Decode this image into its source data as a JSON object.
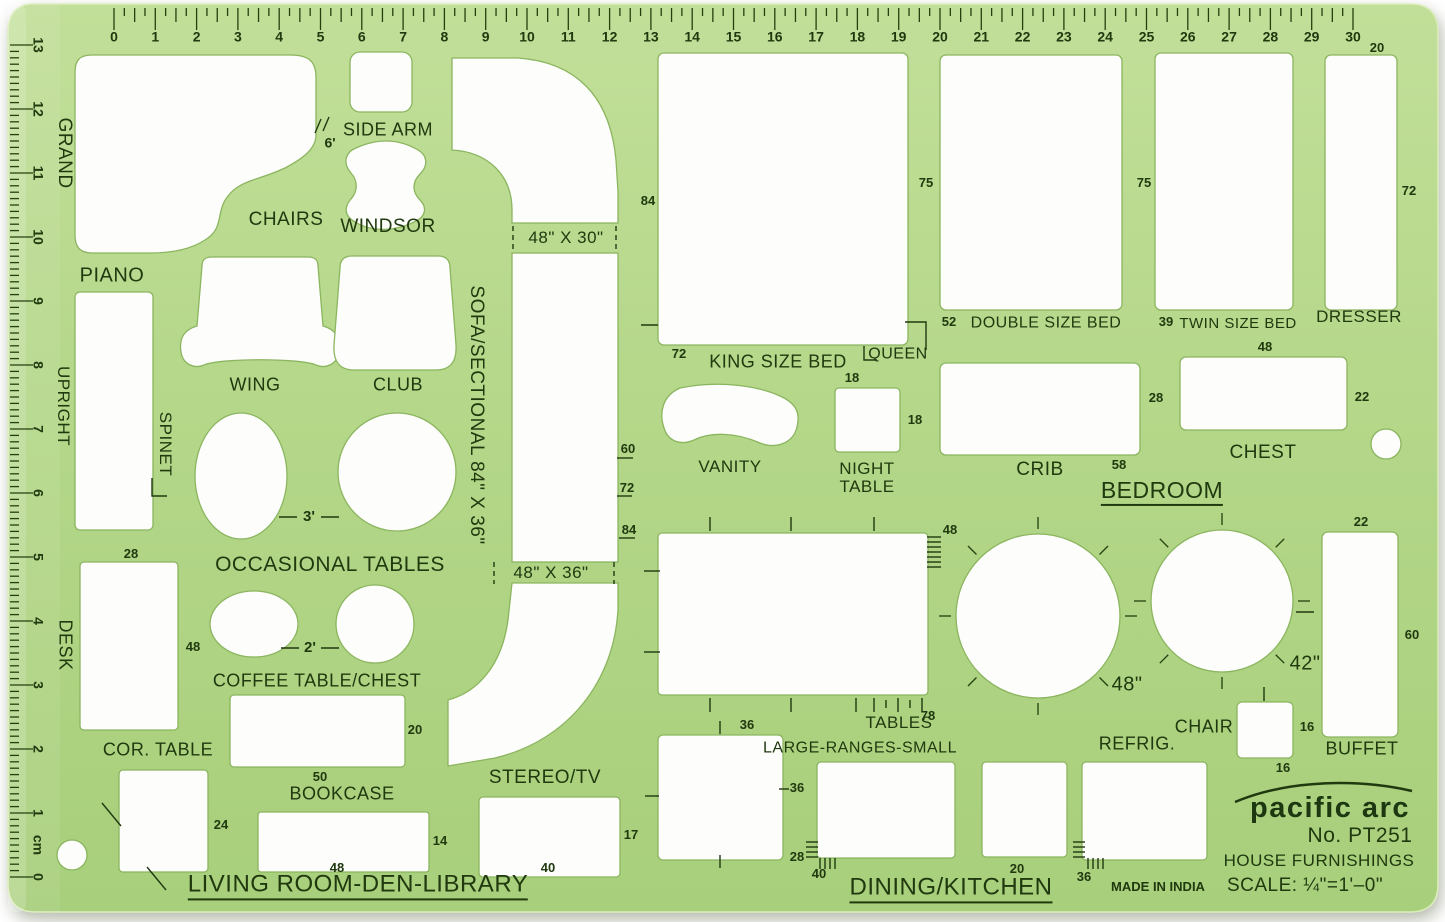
{
  "brand": {
    "logo": "pacific arc",
    "model": "No. PT251",
    "product": "HOUSE FURNISHINGS",
    "scale": "SCALE: ¼\"=1'–0\"",
    "origin": "MADE IN INDIA"
  },
  "sections": {
    "bedroom": "BEDROOM",
    "living": "LIVING ROOM-DEN-LIBRARY",
    "dining": "DINING/KITCHEN"
  },
  "labels": {
    "grand": "GRAND",
    "piano": "PIANO",
    "upright": "UPRIGHT",
    "spinet": "SPINET",
    "chairs": "CHAIRS",
    "windsor": "WINDSOR",
    "side_arm": "SIDE ARM",
    "wing": "WING",
    "club": "CLUB",
    "occasional": "OCCASIONAL TABLES",
    "desk": "DESK",
    "coffee": "COFFEE TABLE/CHEST",
    "cor_table": "COR. TABLE",
    "bookcase": "BOOKCASE",
    "stereo": "STEREO/TV",
    "sofa": "SOFA/SECTIONAL 84\" X 36\"",
    "king": "KING SIZE BED",
    "queen": "QUEEN",
    "vanity": "VANITY",
    "night": "NIGHT TABLE",
    "double": "DOUBLE SIZE BED",
    "twin": "TWIN SIZE BED",
    "dresser": "DRESSER",
    "crib": "CRIB",
    "chest": "CHEST",
    "buffet": "BUFFET",
    "chair": "CHAIR",
    "refrig": "REFRIG.",
    "tables": "TABLES",
    "ranges": "LARGE-RANGES-SMALL"
  },
  "dims": {
    "six_ft": "6'",
    "three_ft": "3'",
    "two_ft": "2'",
    "bridge1": "48\" X 30\"",
    "bridge2": "48\" X 36\"",
    "desk_w": "28",
    "desk_l": "48",
    "coffee_20": "20",
    "cor_24": "24",
    "book_50": "50",
    "book_14": "14",
    "book_48": "48",
    "stereo_17": "17",
    "stereo_40": "40",
    "sofa_84": "84",
    "king_72": "72",
    "side_60": "60",
    "side_72": "72",
    "side_84": "84",
    "night_18a": "18",
    "night_18b": "18",
    "double_52": "52",
    "double_75": "75",
    "twin_39": "39",
    "twin_75": "75",
    "dresser_20": "20",
    "dresser_72": "72",
    "crib_28": "28",
    "crib_58": "58",
    "chest_48": "48",
    "chest_22": "22",
    "buffet_22": "22",
    "buffet_60": "60",
    "chair_16a": "16",
    "chair_16b": "16",
    "round_48": "48\"",
    "round_42": "42\"",
    "dining_48": "48",
    "dining_78": "78",
    "sq_36a": "36",
    "sq_36b": "36",
    "sq_28": "28",
    "sq_40": "40",
    "range_20": "20",
    "refrig_36": "36"
  },
  "rulers": {
    "top": [
      "0",
      "1",
      "2",
      "3",
      "4",
      "5",
      "6",
      "7",
      "8",
      "9",
      "10",
      "11",
      "12",
      "13",
      "14",
      "15",
      "16",
      "17",
      "18",
      "19",
      "20",
      "21",
      "22",
      "23",
      "24",
      "25",
      "26",
      "27",
      "28",
      "29",
      "30"
    ],
    "left": [
      "13",
      "12",
      "11",
      "10",
      "9",
      "8",
      "7",
      "6",
      "5",
      "4",
      "3",
      "2",
      "1",
      "0"
    ],
    "unit": "cm"
  },
  "colors": {
    "plastic": "#b4d789",
    "ink": "#20390f",
    "cutout": "#fdfefc"
  }
}
